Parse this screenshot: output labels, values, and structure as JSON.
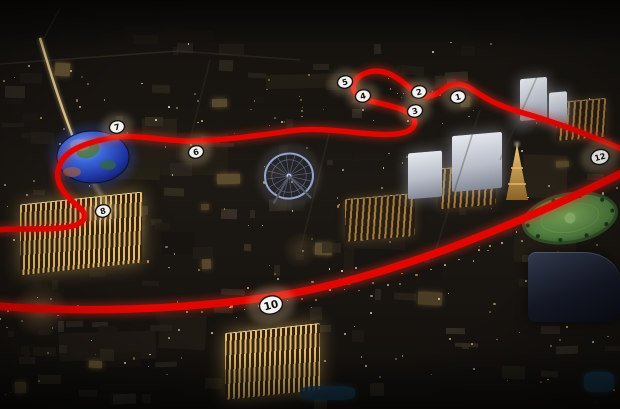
{
  "scene": {
    "title": "Aerial night map of the Las Vegas Strip with street-circuit route overlay",
    "track_color": "#e10600",
    "track_glow_color": "#ff2a1a",
    "marker_fill": "#f4f2ee",
    "marker_border": "#141414",
    "marker_text_color": "#111111"
  },
  "track": {
    "north_section_path": "M 624,150 C 585,133 555,122 520,112 C 495,105 482,96 470,88 C 459,81 448,85 442,90 C 436,95 424,101 412,90 C 400,79 384,66 366,73 C 352,78 349,90 360,97 C 372,104 396,104 410,114 C 418,120 416,130 402,133 C 375,139 330,125 290,131 C 255,136 225,140 195,141 C 165,142 135,133 110,138 C 80,144 62,152 58,170 C 55,186 68,198 80,208 C 90,217 84,226 60,228 C 40,230 15,228 -4,230",
    "strip_straight_path": "M -4,306 C 80,313 180,310 270,297 C 360,284 480,243 624,172"
  },
  "markers": [
    {
      "label": "1",
      "x": 458,
      "y": 97,
      "size": "sm"
    },
    {
      "label": "2",
      "x": 419,
      "y": 92,
      "size": "sm"
    },
    {
      "label": "3",
      "x": 415,
      "y": 111,
      "size": "sm"
    },
    {
      "label": "4",
      "x": 363,
      "y": 96,
      "size": "sm"
    },
    {
      "label": "5",
      "x": 345,
      "y": 82,
      "size": "sm"
    },
    {
      "label": "6",
      "x": 196,
      "y": 152,
      "size": "sm"
    },
    {
      "label": "7",
      "x": 117,
      "y": 127,
      "size": "sm"
    },
    {
      "label": "8",
      "x": 103,
      "y": 211,
      "size": "sm"
    },
    {
      "label": "10",
      "x": 271,
      "y": 305,
      "size": "lg"
    },
    {
      "label": "12",
      "x": 600,
      "y": 157,
      "size": "md"
    }
  ],
  "landmarks": [
    {
      "name": "msg-sphere",
      "type": "sphere",
      "cx": 93,
      "cy": 157,
      "rx": 36,
      "ry": 26
    },
    {
      "name": "high-roller-wheel",
      "type": "wheel",
      "cx": 289,
      "cy": 176,
      "r": 24
    },
    {
      "name": "eiffel-tower-replica",
      "type": "eiffel",
      "cx": 517,
      "top": 144,
      "bottom": 200,
      "halfw": 11
    },
    {
      "name": "bellagio-lawn",
      "type": "lawn",
      "cx": 570,
      "cy": 218,
      "rx": 47,
      "ry": 24
    },
    {
      "name": "venetian-hotel",
      "type": "lit-hotel",
      "x": 20,
      "y": 198,
      "w": 122,
      "h": 70,
      "tone": "gold"
    },
    {
      "name": "treasure-island-hotel",
      "type": "lit-hotel",
      "x": 225,
      "y": 328,
      "w": 95,
      "h": 66,
      "tone": "gold"
    },
    {
      "name": "linq-flamingo-block",
      "type": "lit-hotel",
      "x": 345,
      "y": 196,
      "w": 70,
      "h": 42,
      "tone": "amber"
    },
    {
      "name": "paris-hotel-block",
      "type": "lit-hotel",
      "x": 438,
      "y": 166,
      "w": 58,
      "h": 40,
      "tone": "amber"
    },
    {
      "name": "wynn-encore-block",
      "type": "lit-hotel",
      "x": 556,
      "y": 100,
      "w": 50,
      "h": 38,
      "tone": "amber"
    },
    {
      "name": "white-tower-a",
      "type": "white-tower",
      "x": 452,
      "y": 134,
      "w": 50,
      "h": 56
    },
    {
      "name": "white-tower-b",
      "type": "white-tower",
      "x": 408,
      "y": 152,
      "w": 34,
      "h": 46
    },
    {
      "name": "trump-tower",
      "type": "white-tower",
      "x": 520,
      "y": 78,
      "w": 27,
      "h": 42
    },
    {
      "name": "white-tower-c",
      "type": "white-tower",
      "x": 549,
      "y": 92,
      "w": 18,
      "h": 32
    },
    {
      "name": "bellagio-hotel",
      "type": "dark-hotel",
      "x": 528,
      "y": 252,
      "w": 92,
      "h": 70
    },
    {
      "name": "pool-a",
      "type": "pool",
      "x": 584,
      "y": 372,
      "w": 30,
      "h": 20
    },
    {
      "name": "pool-b",
      "type": "pool",
      "x": 300,
      "y": 386,
      "w": 55,
      "h": 14
    }
  ]
}
